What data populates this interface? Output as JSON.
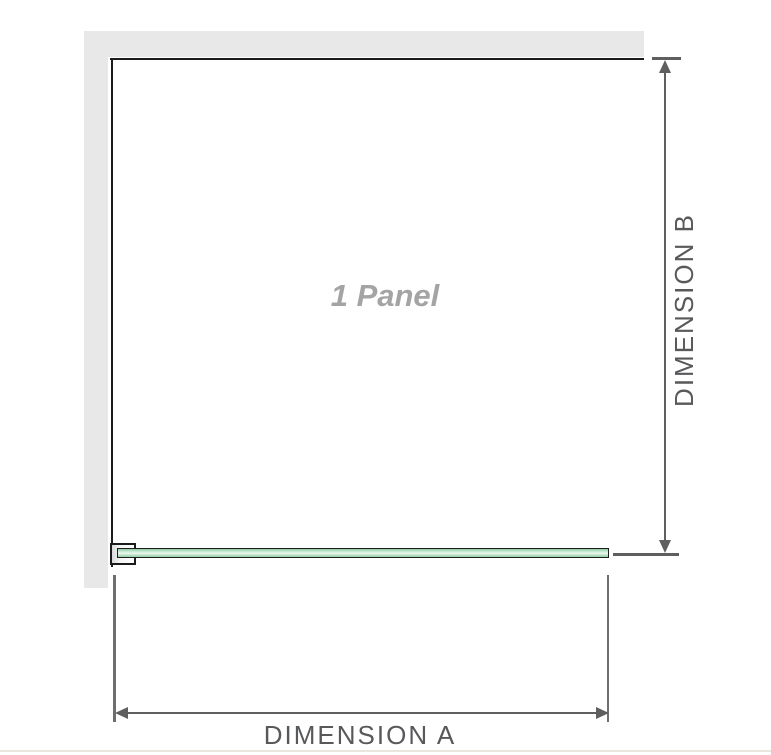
{
  "diagram": {
    "panel_label": "1 Panel",
    "dimension_a_label": "DIMENSION A",
    "dimension_b_label": "DIMENSION B",
    "colors": {
      "wall": "#e8e8e8",
      "panel_outline": "#1b1b1b",
      "dimension_line": "#5f5f5f",
      "extension_line": "#6f6f6f",
      "dimension_label_text": "#58595b",
      "panel_label_text": "#a4a4a4",
      "glass_green_dark": "#8bcaa0",
      "glass_green_light": "#e9f7ec",
      "footer_rule": "#ebe5de"
    }
  }
}
